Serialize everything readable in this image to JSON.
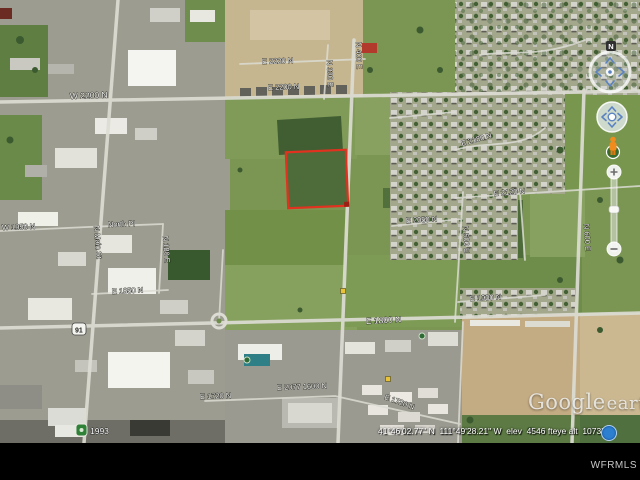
{
  "palette": {
    "parcel_red": "#e0321f",
    "status_icon_blue": "#2d7fd0",
    "nav_arrow_blue": "#5b82c2",
    "field_green": "#7b9553",
    "dirt_tan": "#c6b690"
  },
  "map": {
    "street_labels": [
      {
        "text": "W 2200 N",
        "x": 70,
        "y": 99,
        "rot": -2,
        "size": 8.5
      },
      {
        "text": "E 2220 N",
        "x": 262,
        "y": 64,
        "rot": -2
      },
      {
        "text": "E 2200 N",
        "x": 268,
        "y": 90,
        "rot": -2
      },
      {
        "text": "N 330 E",
        "x": 327,
        "y": 60,
        "rot": 88
      },
      {
        "text": "N 400 E",
        "x": 356,
        "y": 42,
        "rot": 88
      },
      {
        "text": "E 2180 N",
        "x": 462,
        "y": 146,
        "rot": -16
      },
      {
        "text": "E 2120 N",
        "x": 494,
        "y": 196,
        "rot": -5
      },
      {
        "text": "E 2050 N",
        "x": 406,
        "y": 223,
        "rot": -3
      },
      {
        "text": "N 500 E",
        "x": 463,
        "y": 226,
        "rot": 87
      },
      {
        "text": "N 600 E",
        "x": 584,
        "y": 224,
        "rot": 87
      },
      {
        "text": "E 1900 N",
        "x": 470,
        "y": 301,
        "rot": -3
      },
      {
        "text": "W 1950 N",
        "x": 2,
        "y": 230,
        "rot": -2
      },
      {
        "text": "North Pl",
        "x": 108,
        "y": 227,
        "rot": -2
      },
      {
        "text": "N Main St",
        "x": 94,
        "y": 226,
        "rot": 85
      },
      {
        "text": "N 180 E",
        "x": 163,
        "y": 236,
        "rot": 86
      },
      {
        "text": "E 1850 N",
        "x": 112,
        "y": 294,
        "rot": -3
      },
      {
        "text": "E 1800 N",
        "x": 366,
        "y": 324,
        "rot": -3,
        "size": 8.5
      },
      {
        "text": "E 1720 N",
        "x": 200,
        "y": 399,
        "rot": -2
      },
      {
        "text": "E 1720 N",
        "x": 384,
        "y": 399,
        "rot": 20
      },
      {
        "text": "E 2077 1600 N",
        "x": 277,
        "y": 390,
        "rot": -2
      }
    ],
    "route_shield_number": "91",
    "year_overlay": "1993",
    "markers": [
      {
        "icon": "poi-square-yellow",
        "x": 343,
        "y": 291
      },
      {
        "icon": "poi-square-yellow",
        "x": 388,
        "y": 379
      },
      {
        "icon": "poi-dot-green",
        "x": 247,
        "y": 360
      },
      {
        "icon": "poi-dot-green",
        "x": 422,
        "y": 336
      }
    ]
  },
  "watermark": {
    "google": "Google",
    "earth": "earth"
  },
  "mls": "WFRMLS",
  "status": {
    "coords": "41°46'02.77\" N  111°49'28.21\" W",
    "elev": "elev  4546 ft",
    "eye_alt": "eye alt  10737 ft"
  },
  "nav": {
    "north": "N"
  }
}
